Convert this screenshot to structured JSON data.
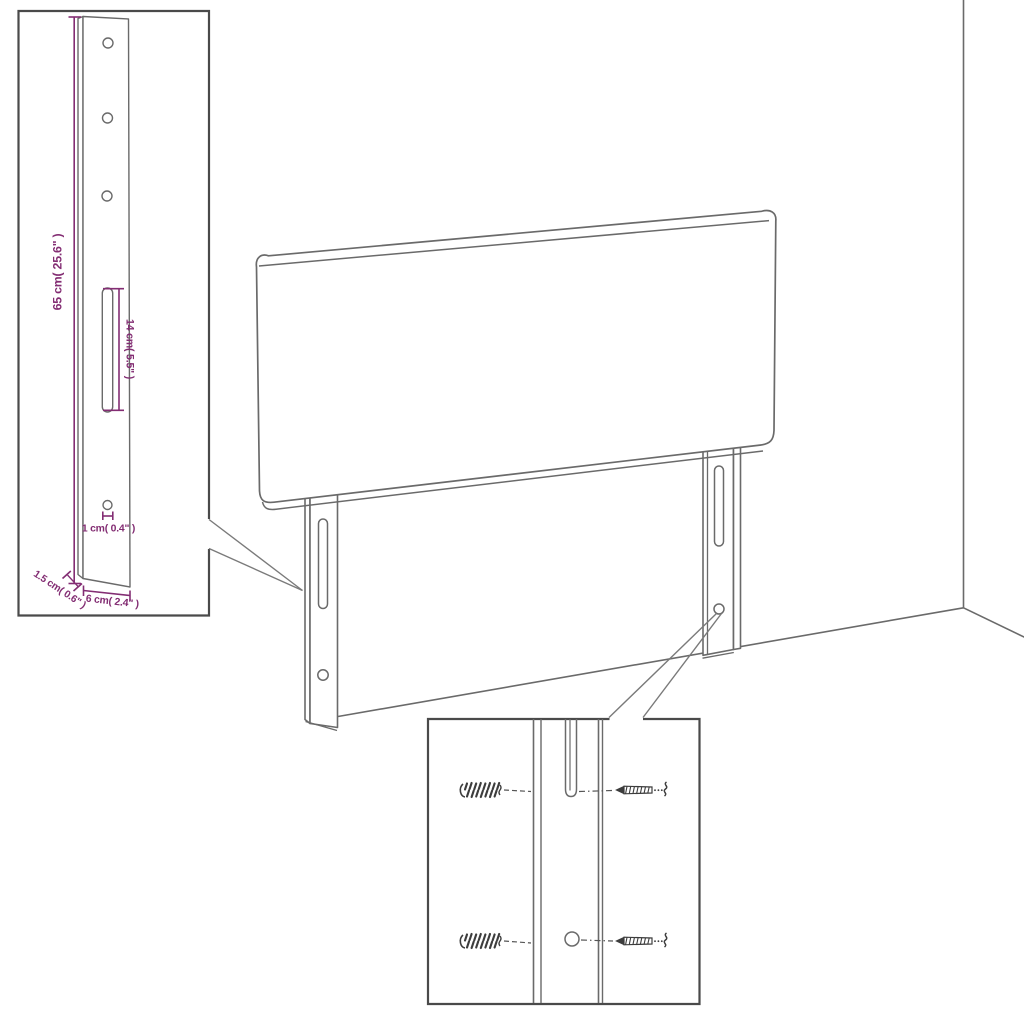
{
  "colors": {
    "dimension": "#832d73",
    "line": "#6a6a6a",
    "box_border": "#4a4a4a",
    "hardware": "#3d3d3d",
    "background": "#ffffff"
  },
  "leg_inset": {
    "height_label": "65 cm( 25.6\" )",
    "slot_label": "14 cm( 5.5\" )",
    "hole_label": "1 cm( 0.4\" )",
    "depth_label": "1.5 cm( 0.6\" )",
    "width_label": "6 cm( 2.4\" )"
  }
}
